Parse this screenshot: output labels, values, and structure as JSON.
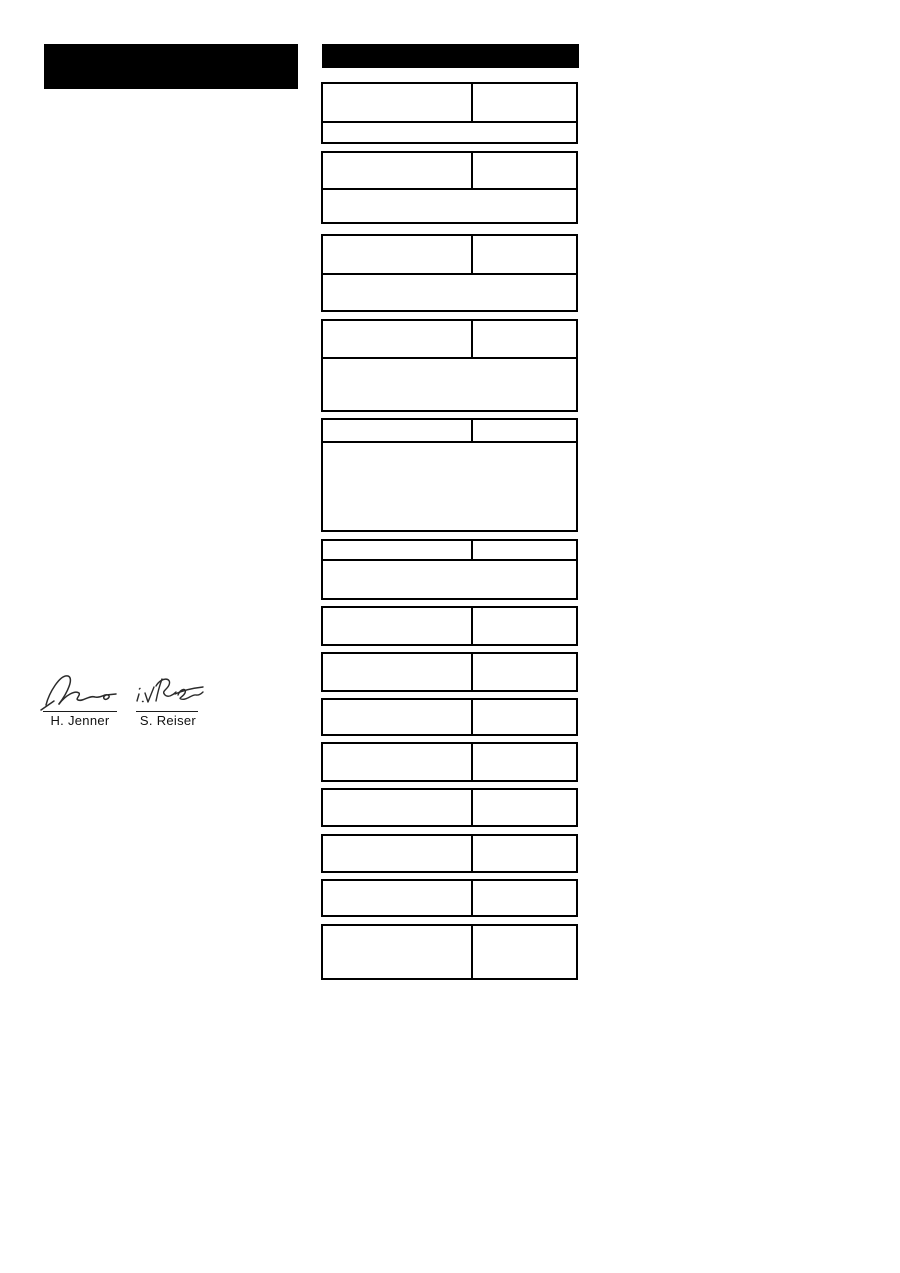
{
  "colors": {
    "paper": "#ffffff",
    "ink": "#000000",
    "signature_ink": "#2b2b2b"
  },
  "redactions": [
    {
      "name": "title-block-redaction"
    },
    {
      "name": "table-header-redaction"
    }
  ],
  "table": {
    "boxes": [
      {
        "top": 82,
        "rows": [
          {
            "type": "split",
            "h": 37
          },
          {
            "type": "full",
            "h": 19
          }
        ]
      },
      {
        "top": 151,
        "rows": [
          {
            "type": "split",
            "h": 35
          },
          {
            "type": "full",
            "h": 32
          }
        ]
      },
      {
        "top": 234,
        "rows": [
          {
            "type": "split",
            "h": 37
          },
          {
            "type": "full",
            "h": 35
          }
        ]
      },
      {
        "top": 319,
        "rows": [
          {
            "type": "split",
            "h": 36
          },
          {
            "type": "full",
            "h": 51
          }
        ]
      },
      {
        "top": 418,
        "rows": [
          {
            "type": "split",
            "h": 21
          },
          {
            "type": "full",
            "h": 87
          }
        ]
      },
      {
        "top": 539,
        "rows": [
          {
            "type": "split",
            "h": 18
          },
          {
            "type": "full",
            "h": 37
          }
        ]
      },
      {
        "top": 606,
        "rows": [
          {
            "type": "split",
            "h": 36
          }
        ]
      },
      {
        "top": 652,
        "rows": [
          {
            "type": "split",
            "h": 36
          }
        ]
      },
      {
        "top": 698,
        "rows": [
          {
            "type": "split",
            "h": 34
          }
        ]
      },
      {
        "top": 742,
        "rows": [
          {
            "type": "split",
            "h": 36
          }
        ]
      },
      {
        "top": 788,
        "rows": [
          {
            "type": "split",
            "h": 35
          }
        ]
      },
      {
        "top": 834,
        "rows": [
          {
            "type": "split",
            "h": 35
          }
        ]
      },
      {
        "top": 879,
        "rows": [
          {
            "type": "split",
            "h": 34
          }
        ]
      },
      {
        "top": 924,
        "rows": [
          {
            "type": "split",
            "h": 52
          }
        ]
      }
    ]
  },
  "signatures": [
    {
      "name": "H. Jenner"
    },
    {
      "name": "S. Reiser"
    }
  ]
}
